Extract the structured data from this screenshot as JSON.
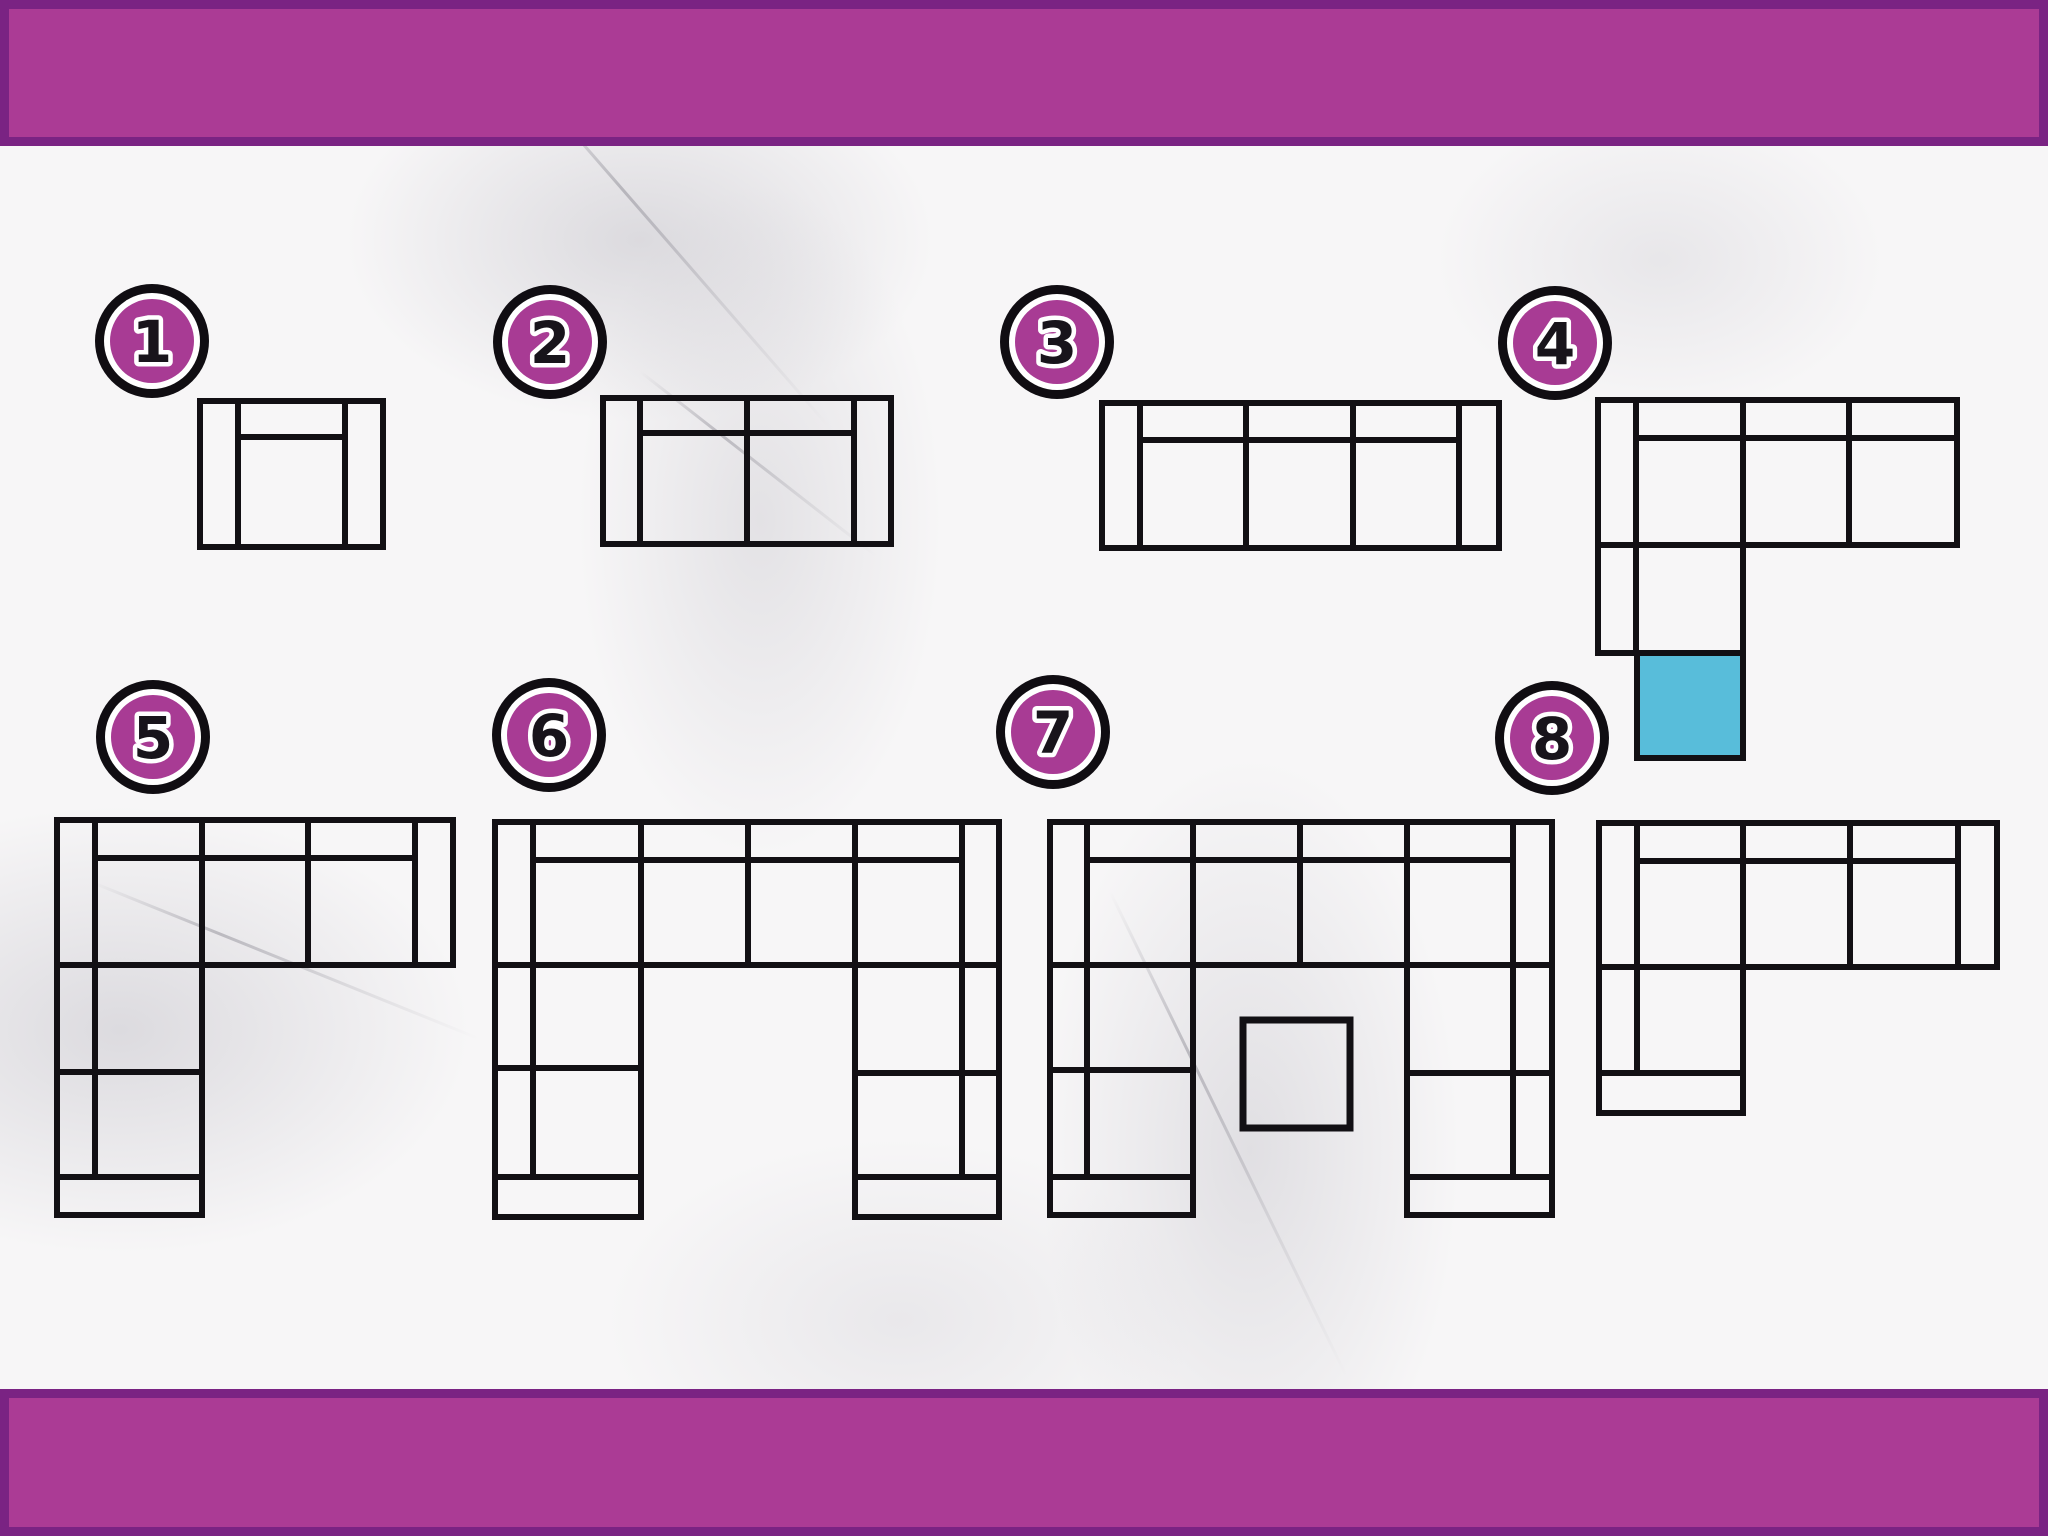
{
  "canvas": {
    "width": 2048,
    "height": 1536
  },
  "colors": {
    "background": "#f7f6f7",
    "bar_fill": "#ab3b95",
    "bar_border": "#7a2383",
    "badge_fill": "#a83b94",
    "badge_ring_black": "#100d12",
    "badge_ring_white": "#ffffff",
    "badge_number_fill": "#18141b",
    "badge_number_outline": "#ffffff",
    "line": "#121014",
    "highlight_fill": "#58bdda"
  },
  "top_bar": {
    "x": 0,
    "y": 0,
    "w": 2048,
    "h": 146
  },
  "bottom_bar": {
    "x": 0,
    "y": 1389,
    "w": 2048,
    "h": 147
  },
  "badges": [
    {
      "label": "1",
      "cx": 152,
      "cy": 341
    },
    {
      "label": "2",
      "cx": 550,
      "cy": 342
    },
    {
      "label": "3",
      "cx": 1057,
      "cy": 342
    },
    {
      "label": "4",
      "cx": 1555,
      "cy": 343
    },
    {
      "label": "5",
      "cx": 153,
      "cy": 737
    },
    {
      "label": "6",
      "cx": 549,
      "cy": 735
    },
    {
      "label": "7",
      "cx": 1053,
      "cy": 732
    },
    {
      "label": "8",
      "cx": 1552,
      "cy": 738
    }
  ],
  "badge_radius": 57,
  "sofas": [
    {
      "id": 1,
      "rects": [
        [
          200,
          401,
          38,
          146
        ],
        [
          345,
          401,
          38,
          146
        ],
        [
          238,
          401,
          107,
          36
        ],
        [
          238,
          437,
          107,
          110
        ]
      ]
    },
    {
      "id": 2,
      "rects": [
        [
          603,
          398,
          37,
          146
        ],
        [
          854,
          398,
          37,
          146
        ],
        [
          640,
          398,
          107,
          35
        ],
        [
          747,
          398,
          107,
          35
        ],
        [
          640,
          433,
          107,
          111
        ],
        [
          747,
          433,
          107,
          111
        ]
      ]
    },
    {
      "id": 3,
      "rects": [
        [
          1102,
          403,
          38,
          145
        ],
        [
          1459,
          403,
          40,
          145
        ],
        [
          1140,
          403,
          106,
          37
        ],
        [
          1246,
          403,
          107,
          37
        ],
        [
          1353,
          403,
          106,
          37
        ],
        [
          1140,
          440,
          106,
          108
        ],
        [
          1246,
          440,
          107,
          108
        ],
        [
          1353,
          440,
          106,
          108
        ]
      ]
    },
    {
      "id": 4,
      "rects": [
        [
          1598,
          400,
          38,
          145
        ],
        [
          1636,
          400,
          107,
          38
        ],
        [
          1743,
          400,
          106,
          38
        ],
        [
          1849,
          400,
          108,
          38
        ],
        [
          1636,
          438,
          107,
          107
        ],
        [
          1743,
          438,
          106,
          107
        ],
        [
          1849,
          438,
          108,
          107
        ],
        [
          1598,
          545,
          38,
          108
        ],
        [
          1636,
          545,
          107,
          108
        ]
      ]
    },
    {
      "id": 5,
      "rects": [
        [
          57,
          820,
          38,
          145
        ],
        [
          415,
          820,
          38,
          145
        ],
        [
          95,
          820,
          107,
          38
        ],
        [
          202,
          820,
          106,
          38
        ],
        [
          308,
          820,
          107,
          38
        ],
        [
          95,
          858,
          107,
          107
        ],
        [
          202,
          858,
          106,
          107
        ],
        [
          308,
          858,
          107,
          107
        ],
        [
          57,
          965,
          38,
          107
        ],
        [
          95,
          965,
          107,
          107
        ],
        [
          57,
          1072,
          38,
          105
        ],
        [
          95,
          1072,
          107,
          105
        ],
        [
          57,
          1177,
          145,
          38
        ]
      ]
    },
    {
      "id": 6,
      "rects": [
        [
          495,
          822,
          38,
          143
        ],
        [
          962,
          822,
          37,
          143
        ],
        [
          533,
          822,
          108,
          38
        ],
        [
          641,
          822,
          107,
          38
        ],
        [
          748,
          822,
          107,
          38
        ],
        [
          855,
          822,
          107,
          38
        ],
        [
          533,
          860,
          108,
          105
        ],
        [
          641,
          860,
          107,
          105
        ],
        [
          748,
          860,
          107,
          105
        ],
        [
          855,
          860,
          107,
          105
        ],
        [
          495,
          965,
          38,
          103
        ],
        [
          533,
          965,
          108,
          103
        ],
        [
          495,
          1068,
          38,
          109
        ],
        [
          533,
          1068,
          108,
          109
        ],
        [
          495,
          1177,
          146,
          40
        ],
        [
          855,
          965,
          107,
          108
        ],
        [
          962,
          965,
          37,
          108
        ],
        [
          855,
          1073,
          107,
          104
        ],
        [
          962,
          1073,
          37,
          104
        ],
        [
          855,
          1177,
          144,
          40
        ]
      ]
    },
    {
      "id": 7,
      "rects": [
        [
          1050,
          822,
          37,
          143
        ],
        [
          1513,
          822,
          39,
          143
        ],
        [
          1087,
          822,
          106,
          38
        ],
        [
          1193,
          822,
          107,
          38
        ],
        [
          1300,
          822,
          107,
          38
        ],
        [
          1407,
          822,
          106,
          38
        ],
        [
          1087,
          860,
          106,
          105
        ],
        [
          1193,
          860,
          107,
          105
        ],
        [
          1300,
          860,
          107,
          105
        ],
        [
          1407,
          860,
          106,
          105
        ],
        [
          1050,
          965,
          37,
          105
        ],
        [
          1087,
          965,
          106,
          105
        ],
        [
          1050,
          1070,
          37,
          107
        ],
        [
          1087,
          1070,
          106,
          107
        ],
        [
          1050,
          1177,
          143,
          38
        ],
        [
          1407,
          965,
          106,
          108
        ],
        [
          1513,
          965,
          39,
          108
        ],
        [
          1407,
          1073,
          106,
          104
        ],
        [
          1513,
          1073,
          39,
          104
        ],
        [
          1407,
          1177,
          145,
          38
        ]
      ]
    },
    {
      "id": 8,
      "rects": [
        [
          1599,
          823,
          38,
          144
        ],
        [
          1958,
          823,
          39,
          144
        ],
        [
          1637,
          823,
          106,
          38
        ],
        [
          1743,
          823,
          107,
          38
        ],
        [
          1850,
          823,
          108,
          38
        ],
        [
          1637,
          861,
          106,
          106
        ],
        [
          1743,
          861,
          107,
          106
        ],
        [
          1850,
          861,
          108,
          106
        ],
        [
          1599,
          967,
          38,
          106
        ],
        [
          1637,
          967,
          106,
          106
        ],
        [
          1599,
          1073,
          144,
          40
        ]
      ]
    }
  ],
  "ottoman": {
    "x": 1243,
    "y": 1020,
    "w": 107,
    "h": 108
  },
  "highlight_square": {
    "x": 1637,
    "y": 653,
    "w": 106,
    "h": 105
  }
}
